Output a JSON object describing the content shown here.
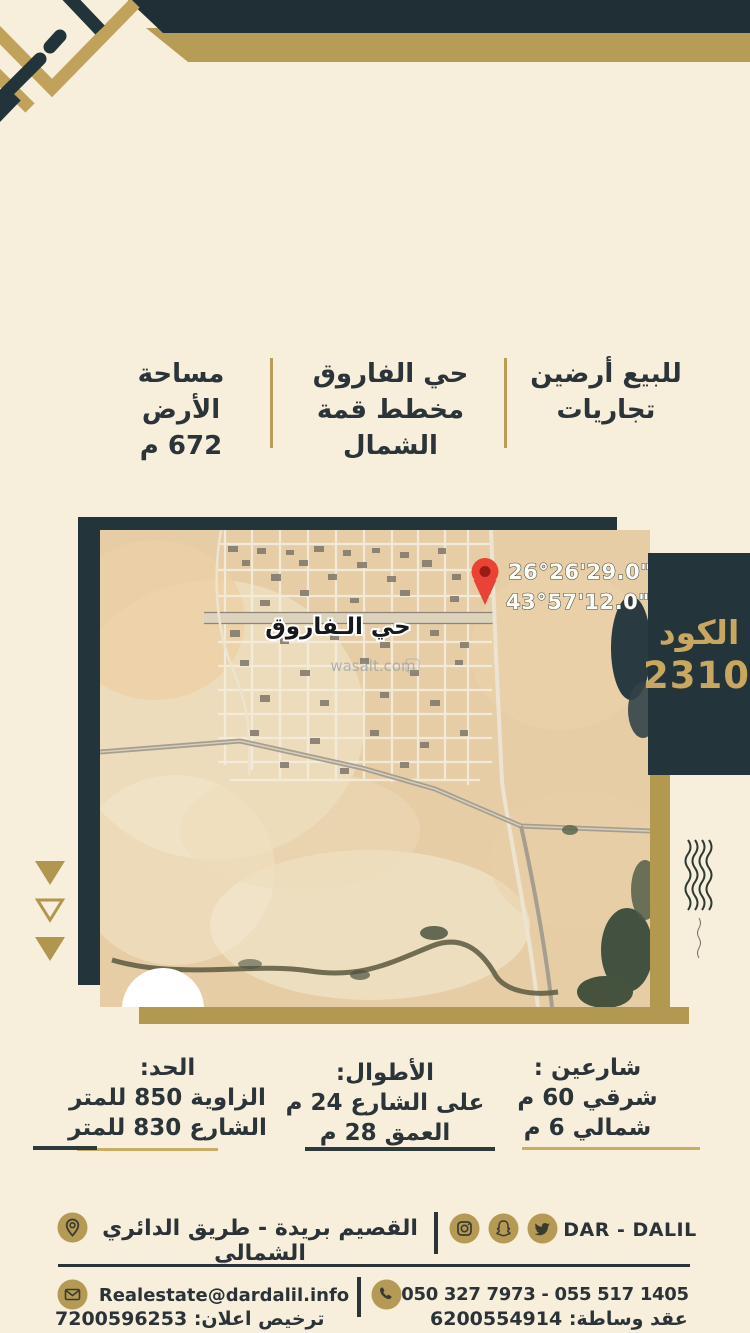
{
  "summary": {
    "offer_line1": "للبيع أرضين",
    "offer_line2": "تجاريات",
    "district_line1": "حي الفاروق",
    "district_line2": "مخطط قمة الشمال",
    "area_label": "مساحة الأرض",
    "area_value": "672 م"
  },
  "map": {
    "district_label": "حي الـفاروق",
    "watermark": "wasalt.com",
    "lat": "26°26'29.0\"N",
    "lng": "43°57'12.0\"E"
  },
  "code": {
    "label": "الكود",
    "value": "2310"
  },
  "details": {
    "streets_title": "شارعين :",
    "streets_line1": "شرقي 60 م",
    "streets_line2": "شمالي 6 م",
    "lengths_title": "الأطوال:",
    "lengths_line1": "على الشارع 24 م",
    "lengths_line2": "العمق 28 م",
    "limit_title": "الحد:",
    "limit_line1": "الزاوية 850 للمتر",
    "limit_line2": "الشارع 830 للمتر"
  },
  "footer": {
    "brand": "DAR - DALIL",
    "address": "القصيم بريدة - طريق الدائري الشمالي",
    "email": "Realestate@dardalil.info",
    "phones": "050 327 7973 - 055 517 1405",
    "contract": "عقد وساطة: 6200554914",
    "license": "ترخيص اعلان: 7200596253"
  },
  "colors": {
    "navy": "#24343b",
    "gold": "#b49a55",
    "gold_text": "#c9a75e",
    "cream": "#f7efdb",
    "pin_red": "#e94335"
  }
}
